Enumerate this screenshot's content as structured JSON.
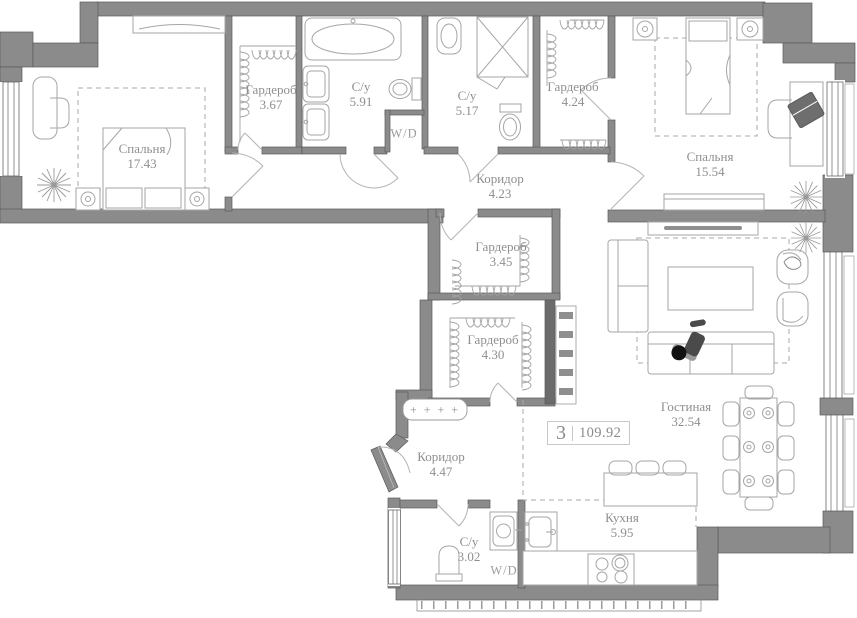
{
  "plan": {
    "badge": {
      "rooms_count": "3",
      "total_area": "109.92"
    },
    "rooms": [
      {
        "key": "bedroom-1",
        "name": "Спальня",
        "area": "17.43"
      },
      {
        "key": "wardrobe-1",
        "name": "Гардероб",
        "area": "3.67"
      },
      {
        "key": "bathroom-1",
        "name": "С/у",
        "area": "5.91"
      },
      {
        "key": "bathroom-2",
        "name": "С/у",
        "area": "5.17"
      },
      {
        "key": "wardrobe-2",
        "name": "Гардероб",
        "area": "4.24"
      },
      {
        "key": "bedroom-2",
        "name": "Спальня",
        "area": "15.54"
      },
      {
        "key": "corridor-1",
        "name": "Коридор",
        "area": "4.23"
      },
      {
        "key": "wardrobe-3",
        "name": "Гардероб",
        "area": "3.45"
      },
      {
        "key": "wardrobe-4",
        "name": "Гардероб",
        "area": "4.30"
      },
      {
        "key": "corridor-2",
        "name": "Коридор",
        "area": "4.47"
      },
      {
        "key": "bathroom-3",
        "name": "С/у",
        "area": "3.02"
      },
      {
        "key": "kitchen",
        "name": "Кухня",
        "area": "5.95"
      },
      {
        "key": "living-room",
        "name": "Гостиная",
        "area": "32.54"
      }
    ],
    "labels": {
      "washer_dryer": "W/D",
      "radiator": "+ + + +"
    },
    "colors": {
      "wall": "#8b8b8b",
      "wall_dark": "#6b6b6b",
      "furniture_line": "#a6a6a6",
      "text": "#8f8f8f",
      "background": "#ffffff"
    }
  }
}
